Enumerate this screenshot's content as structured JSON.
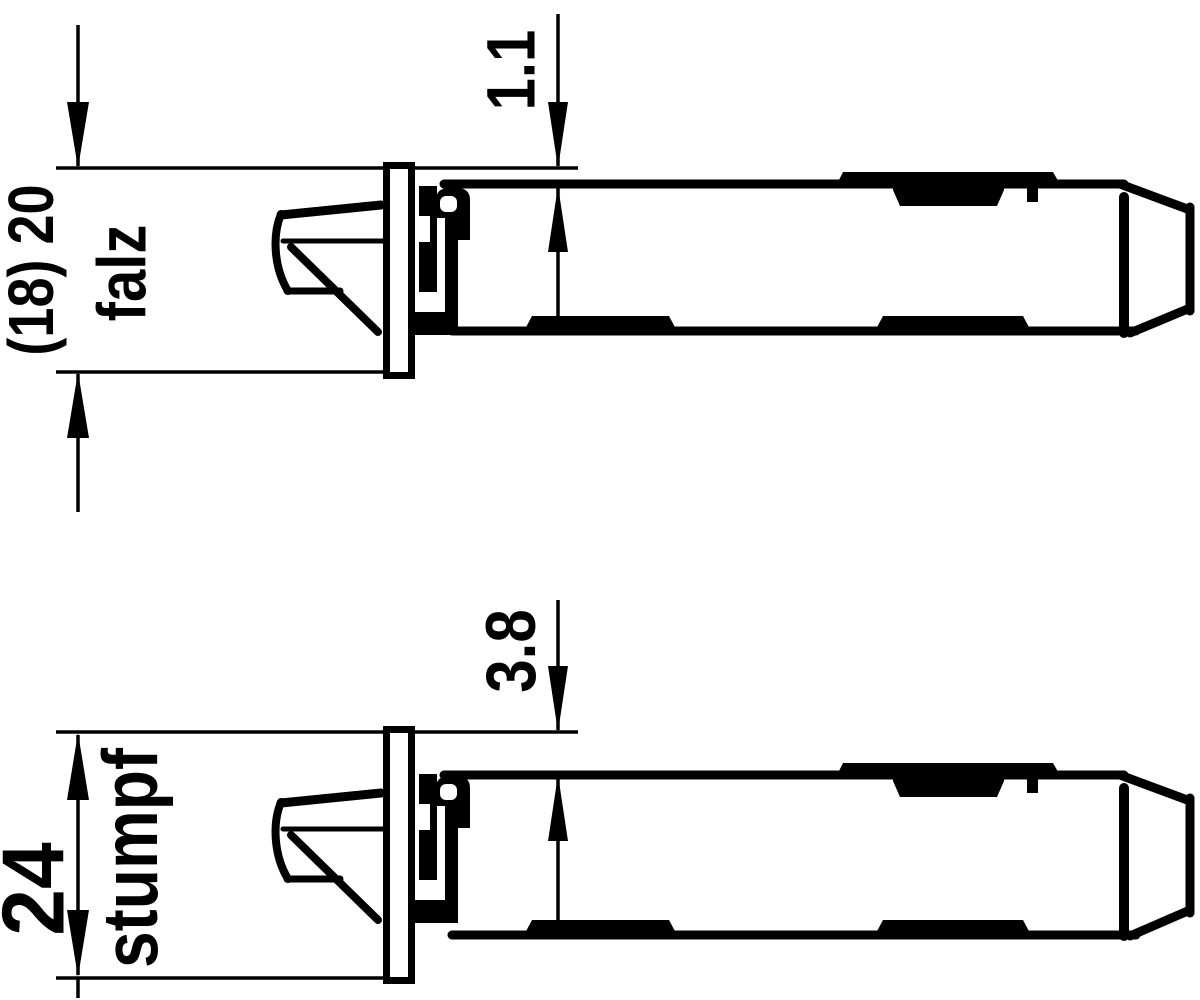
{
  "drawing": {
    "background_color": "#ffffff",
    "ink_color": "#000000",
    "description": "Two side views of a latch bolt with faceplate, for rebated (falz) and flush (stumpf) door mounting",
    "views": [
      {
        "id": "falz",
        "mount_label": "falz",
        "plate_width_dimension": "(18) 20",
        "offset_dimension": "1.1"
      },
      {
        "id": "stumpf",
        "mount_label": "stumpf",
        "plate_width_dimension": "24",
        "offset_dimension": "3.8"
      }
    ]
  }
}
